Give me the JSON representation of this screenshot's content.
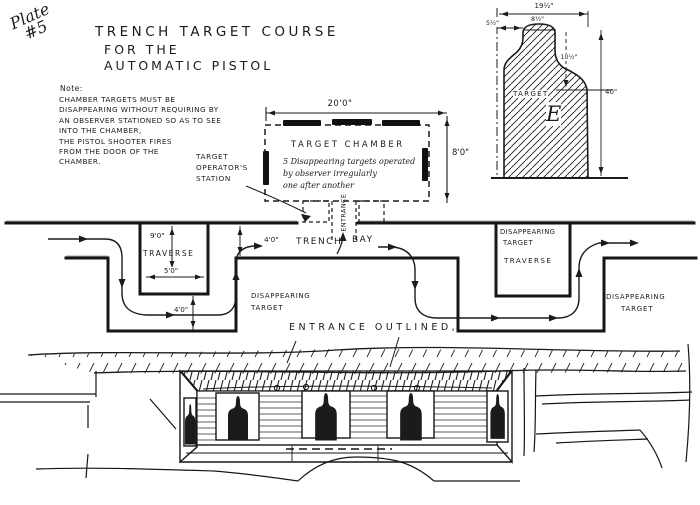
{
  "plate": {
    "word": "Plate",
    "number": "#5"
  },
  "title": {
    "line1": "TRENCH TARGET COURSE",
    "line2": "FOR THE",
    "line3": "AUTOMATIC PISTOL"
  },
  "note": {
    "heading": "Note:",
    "lines": [
      "CHAMBER TARGETS MUST BE",
      "DISAPPEARING WITHOUT REQUIRING BY",
      "AN OBSERVER STATIONED SO AS TO SEE",
      "INTO THE CHAMBER,",
      "THE PISTOL SHOOTER FIRES",
      "FROM THE DOOR OF THE",
      "CHAMBER."
    ]
  },
  "operator_station": {
    "line1": "TARGET",
    "line2": "OPERATOR'S",
    "line3": "STATION"
  },
  "target_chamber": {
    "title": "TARGET CHAMBER",
    "description_line1": "5 Disappearing targets operated",
    "description_line2": "by observer irregularly",
    "description_line3": "one after another",
    "width_dim": "20'0\"",
    "height_dim": "8'0\"",
    "entrance_label": "ENTRANCE"
  },
  "target_e_detail": {
    "label": "TARGET",
    "letter": "E",
    "overall_width_dim": "19½\"",
    "left_offset_dim": "5½\"",
    "head_width_dim": "8½\"",
    "head_height_dim": "10½\"",
    "overall_height_dim": "40\""
  },
  "trench_plan": {
    "trench_label": "TRENCH",
    "bay_label": "BAY",
    "bay_width_dim": "4'0\"",
    "left_traverse": {
      "depth_dim": "9'0\"",
      "label": "TRAVERSE",
      "width_dim": "5'0\"",
      "offset_dim": "4'0\""
    },
    "right_traverse": {
      "target_line1": "DISAPPEARING",
      "target_line2": "TARGET",
      "label": "TRAVERSE"
    },
    "disappearing_target_mid": {
      "line1": "DISAPPEARING",
      "line2": "TARGET"
    },
    "disappearing_target_right": {
      "line1": "DISAPPEARING",
      "line2": "TARGET"
    }
  },
  "elevation": {
    "caption": "ENTRANCE OUTLINED,"
  },
  "colors": {
    "ink": "#1b1b1b",
    "paper": "#ffffff"
  }
}
